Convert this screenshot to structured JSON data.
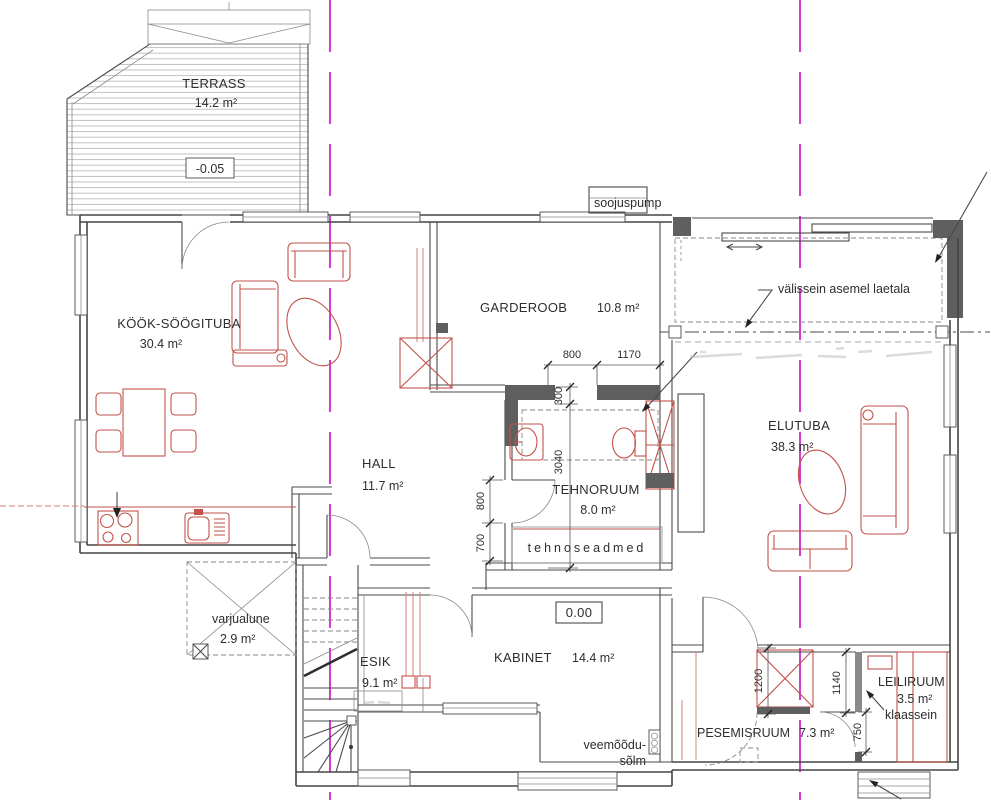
{
  "colors": {
    "axis": "#d03fd0",
    "furniture": "#c2524a",
    "wall": "#454545",
    "wall_fill": "#5f5f5f"
  },
  "rooms": {
    "terrass": {
      "name": "TERRASS",
      "area": "14.2 m²",
      "level": "-0.05"
    },
    "kook": {
      "name": "KÖÖK-SÖÖGITUBA",
      "area": "30.4 m²"
    },
    "garderoob": {
      "name": "GARDEROOB",
      "area": "10.8 m²"
    },
    "elutuba": {
      "name": "ELUTUBA",
      "area": "38.3 m²"
    },
    "hall": {
      "name": "HALL",
      "area": "11.7 m²"
    },
    "tehnoruum": {
      "name": "TEHNORUUM",
      "area": "8.0 m²"
    },
    "esik": {
      "name": "ESIK",
      "area": "9.1 m²"
    },
    "kabinet": {
      "name": "KABINET",
      "area": "14.4 m²"
    },
    "pesemisruum": {
      "name": "PESEMISRUUM",
      "area": "7.3 m²"
    },
    "leiliruum": {
      "name": "LEILIRUUM",
      "area": "3.5 m²",
      "note": "klaassein"
    },
    "varjualune": {
      "name": "varjualune",
      "area": "2.9 m²"
    }
  },
  "labels": {
    "soojuspump": "soojuspump",
    "valissein": "välissein asemel laetala",
    "tehnoseadmed": "tehnoseadmed",
    "veemoodu_line1": "veemõõdu-",
    "veemoodu_line2": "sõlm",
    "level_zero": "0.00"
  },
  "dimensions": {
    "garderoob_door": "800",
    "garderoob_wall": "1170",
    "wc_offset": "300",
    "wc_depth": "3040",
    "hall_door": "800",
    "hall_wall": "700",
    "shower": "1200",
    "glass_wall": "1140",
    "sauna_door": "750"
  }
}
